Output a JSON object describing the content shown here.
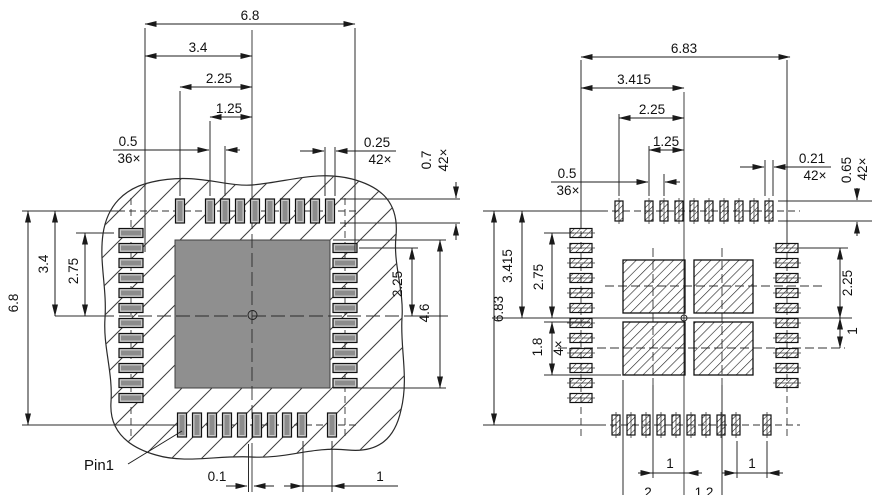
{
  "title": "QFN-42 package and solder land pattern drawing",
  "left_view": {
    "name": "package bottom view",
    "pin1": "Pin1",
    "dims": {
      "width": "6.8",
      "half_width": "3.4",
      "corner_pin_offset": "2.25",
      "first_pin_offset": "1.25",
      "pitch": "0.5",
      "pitch_count": "36×",
      "pad_width": "0.25",
      "pad_width_count": "42×",
      "pad_length": "0.7",
      "pad_length_count": "42×",
      "height": "6.8",
      "half_height": "3.4",
      "side_col_offset": "2.75",
      "right_col_offset": "2.25",
      "die_size": "4.6",
      "center_offset": "0.1",
      "corner_gap": "1"
    }
  },
  "right_view": {
    "name": "solder land pattern view",
    "dims": {
      "width": "6.83",
      "half_width": "3.415",
      "corner_pin_offset": "2.25",
      "first_pin_offset": "1.25",
      "pitch": "0.5",
      "pitch_count": "36×",
      "pad_width": "0.21",
      "pad_width_count": "42×",
      "pad_length": "0.65",
      "pad_length_count": "42×",
      "height": "6.83",
      "half_height": "3.415",
      "side_col_offset": "2.75",
      "quad_height": "1.8",
      "quad_count": "4×",
      "right_col_offset": "2.25",
      "quad_row_offset": "1",
      "bottom_left_gap": "1",
      "bottom_right_gap": "1",
      "bottom_cut_a": "2",
      "bottom_cut_b": "1.2"
    }
  },
  "geometry": {
    "left": {
      "rows": [
        {
          "axis": "x",
          "fixed": 211,
          "w": 9,
          "h": 24,
          "centers": [
            180,
            210,
            225,
            240,
            255,
            270,
            285,
            300,
            315,
            330
          ]
        },
        {
          "axis": "x",
          "fixed": 425,
          "w": 9,
          "h": 24,
          "centers": [
            182,
            197,
            212,
            227,
            242,
            257,
            272,
            287,
            302,
            332
          ]
        },
        {
          "axis": "y",
          "fixed": 131,
          "w": 24,
          "h": 9,
          "centers": [
            233,
            248,
            263,
            278,
            293,
            308,
            323,
            338,
            353,
            368,
            383,
            398
          ]
        },
        {
          "axis": "y",
          "fixed": 345,
          "w": 24,
          "h": 9,
          "centers": [
            248,
            263,
            278,
            293,
            308,
            323,
            338,
            353,
            368,
            383
          ]
        }
      ],
      "die": {
        "x": 175,
        "y": 240,
        "w": 155,
        "h": 148
      }
    },
    "right": {
      "rows": [
        {
          "axis": "x",
          "fixed": 211,
          "w": 8,
          "h": 20,
          "centers": [
            619,
            649,
            664,
            679,
            694,
            709,
            724,
            739,
            754,
            769
          ]
        },
        {
          "axis": "x",
          "fixed": 425,
          "w": 8,
          "h": 20,
          "centers": [
            616,
            631,
            646,
            661,
            676,
            691,
            706,
            721,
            736,
            767
          ]
        },
        {
          "axis": "y",
          "fixed": 581,
          "w": 22,
          "h": 9,
          "centers": [
            233,
            248,
            263,
            278,
            293,
            308,
            323,
            338,
            353,
            368,
            383,
            398
          ]
        },
        {
          "axis": "y",
          "fixed": 787,
          "w": 22,
          "h": 9,
          "centers": [
            248,
            263,
            278,
            293,
            308,
            323,
            338,
            353,
            368,
            383
          ]
        }
      ],
      "quads": [
        {
          "x": 623,
          "y": 260,
          "w": 62,
          "h": 53
        },
        {
          "x": 694,
          "y": 260,
          "w": 59,
          "h": 53
        },
        {
          "x": 623,
          "y": 322,
          "w": 62,
          "h": 53
        },
        {
          "x": 694,
          "y": 322,
          "w": 59,
          "h": 53
        }
      ]
    }
  }
}
